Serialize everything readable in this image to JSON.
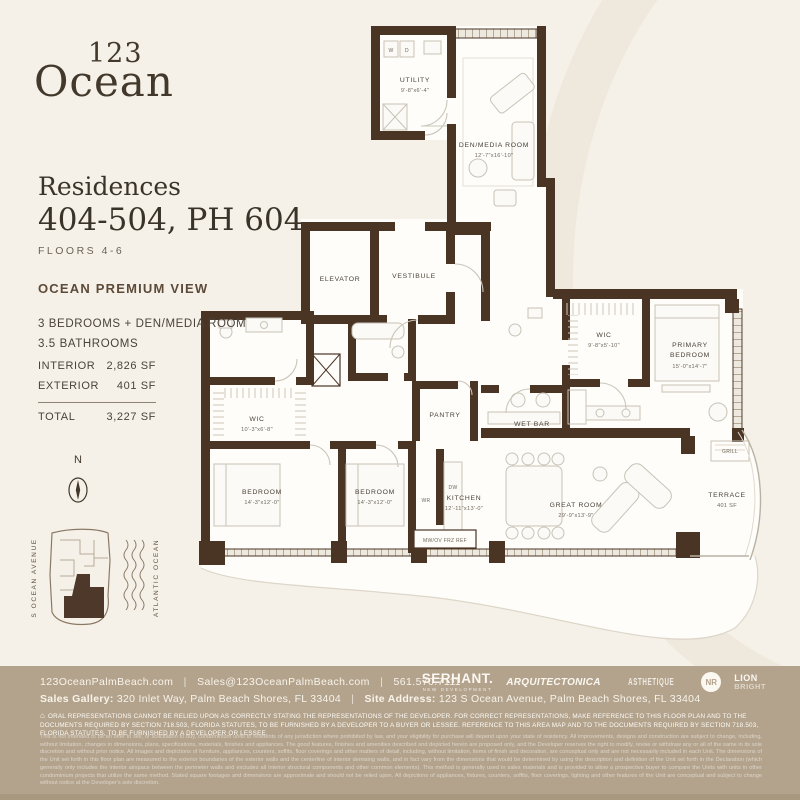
{
  "colors": {
    "background": "#f6f1e8",
    "wall_brown": "#4a3525",
    "footer_tan": "#b3a38d",
    "accent_brown": "#5d4a38",
    "unit_highlight": "#4d3829"
  },
  "logo": {
    "line1": "123",
    "line2": "Ocean"
  },
  "header": {
    "residences_label": "Residences",
    "units": "404-504, PH 604",
    "floors": "FLOORS 4-6"
  },
  "view_label": "OCEAN PREMIUM VIEW",
  "features": {
    "line1": "3 BEDROOMS + DEN/MEDIA ROOM",
    "line2": "3.5 BATHROOMS"
  },
  "areas": {
    "rows": [
      {
        "label": "INTERIOR",
        "value": "2,826 SF"
      },
      {
        "label": "EXTERIOR",
        "value": "401 SF"
      }
    ],
    "total_label": "TOTAL",
    "total_value": "3,227 SF"
  },
  "compass": {
    "label": "N"
  },
  "site_map": {
    "street_label": "S OCEAN AVENUE",
    "ocean_label": "ATLANTIC OCEAN"
  },
  "plan": {
    "rooms": {
      "utility": {
        "name": "UTILITY",
        "dims": "9'-8\"x6'-4\""
      },
      "den": {
        "name": "DEN/MEDIA ROOM",
        "dims": "12'-7\"x16'-10\""
      },
      "elevator": {
        "name": "ELEVATOR"
      },
      "vestibule": {
        "name": "VESTIBULE"
      },
      "wic_primary": {
        "name": "WIC",
        "dims": "9'-8\"x5'-10\""
      },
      "primary": {
        "name_line1": "PRIMARY",
        "name_line2": "BEDROOM",
        "dims": "15'-0\"x14'-7\""
      },
      "wet_bar": {
        "name": "WET BAR"
      },
      "pantry": {
        "name": "PANTRY"
      },
      "wic_left": {
        "name": "WIC",
        "dims": "10'-3\"x6'-8\""
      },
      "bedroom1": {
        "name": "BEDROOM",
        "dims": "14'-3\"x12'-0\""
      },
      "bedroom2": {
        "name": "BEDROOM",
        "dims": "14'-3\"x12'-0\""
      },
      "kitchen": {
        "name": "KITCHEN",
        "dims": "12'-11\"x13'-0\""
      },
      "great_room": {
        "name": "GREAT ROOM",
        "dims": "29'-9\"x13'-9\""
      },
      "terrace": {
        "name": "TERRACE",
        "dims": "401 SF"
      },
      "grill": {
        "name": "GRILL"
      }
    },
    "fixtures": {
      "washer": "W",
      "dryer": "D",
      "dishwasher": "DW",
      "wr": "WR",
      "appliance_row": "MW/OV FRZ REF"
    }
  },
  "footer": {
    "website": "123OceanPalmBeach.com",
    "email": "Sales@123OceanPalmBeach.com",
    "phone": "561.570.7111",
    "separator": "|",
    "sales_gallery_label": "Sales Gallery:",
    "sales_gallery_value": " 320 Inlet Way, Palm Beach Shores, FL 33404",
    "site_address_label": "Site Address:",
    "site_address_value": " 123 S Ocean Avenue, Palm Beach Shores, FL 33404",
    "logos": {
      "serhant": "SERHANT.",
      "serhant_sub": "NEW DEVELOPMENT",
      "arquitectonica": "ARQUITECTONICA",
      "asthetique": "ASTHETIQUE",
      "nr": "NR",
      "lion_line1": "LION",
      "lion_line2": "BRIGHT"
    },
    "house_icon": "⌂",
    "disclaimer_caps": "ORAL REPRESENTATIONS CANNOT BE RELIED UPON AS CORRECTLY STATING THE REPRESENTATIONS OF THE DEVELOPER. FOR CORRECT REPRESENTATIONS, MAKE REFERENCE TO THIS FLOOR PLAN AND TO THE DOCUMENTS REQUIRED BY SECTION 718.503, FLORIDA STATUTES, TO BE FURNISHED BY A DEVELOPER TO A BUYER OR LESSEE. REFERENCE TO THIS AREA MAP AND TO THE DOCUMENTS REQUIRED BY SECTION 718.503, FLORIDA STATUTES, TO BE FURNISHED BY A DEVELOPER OR LESSEE.",
    "fine_print": "This is not intended to be an offer to sell, or solicitation to buy, condominium units to residents of any jurisdiction where prohibited by law, and your eligibility for purchase will depend upon your state of residency. All improvements, designs and construction are subject to change, including, without limitation, changes in dimensions, plans, specifications, materials, finishes and appliances. The good features, finishes and amenities described and depicted herein are proposed only, and the Developer reserves the right to modify, revise or withdraw any or all of the same in its sole discretion and without prior notice. All images and depictions of furniture, appliances, counters, soffits, floor coverings and other matters of detail, including, without limitation, items of finish and decoration, are conceptual only and are not necessarily included in each Unit. The dimensions of the Unit set forth in this floor plan are measured to the exterior boundaries of the exterior walls and the centerline of interior demising walls, and in fact vary from the dimensions that would be determined by using the description and definition of the Unit set forth in the Declaration (which generally only includes the interior airspace between the perimeter walls and excludes all interior structural components and other common elements). This method is generally used in sales materials and is provided to allow a prospective buyer to compare the Units with units in other condominium projects that utilize the same method. Stated square footages and dimensions are approximate and should not be relied upon. All depictions of appliances, fixtures, counters, soffits, floor coverings, lighting and other features of the Unit are conceptual and subject to change without notice at the Developer's sole discretion."
  }
}
